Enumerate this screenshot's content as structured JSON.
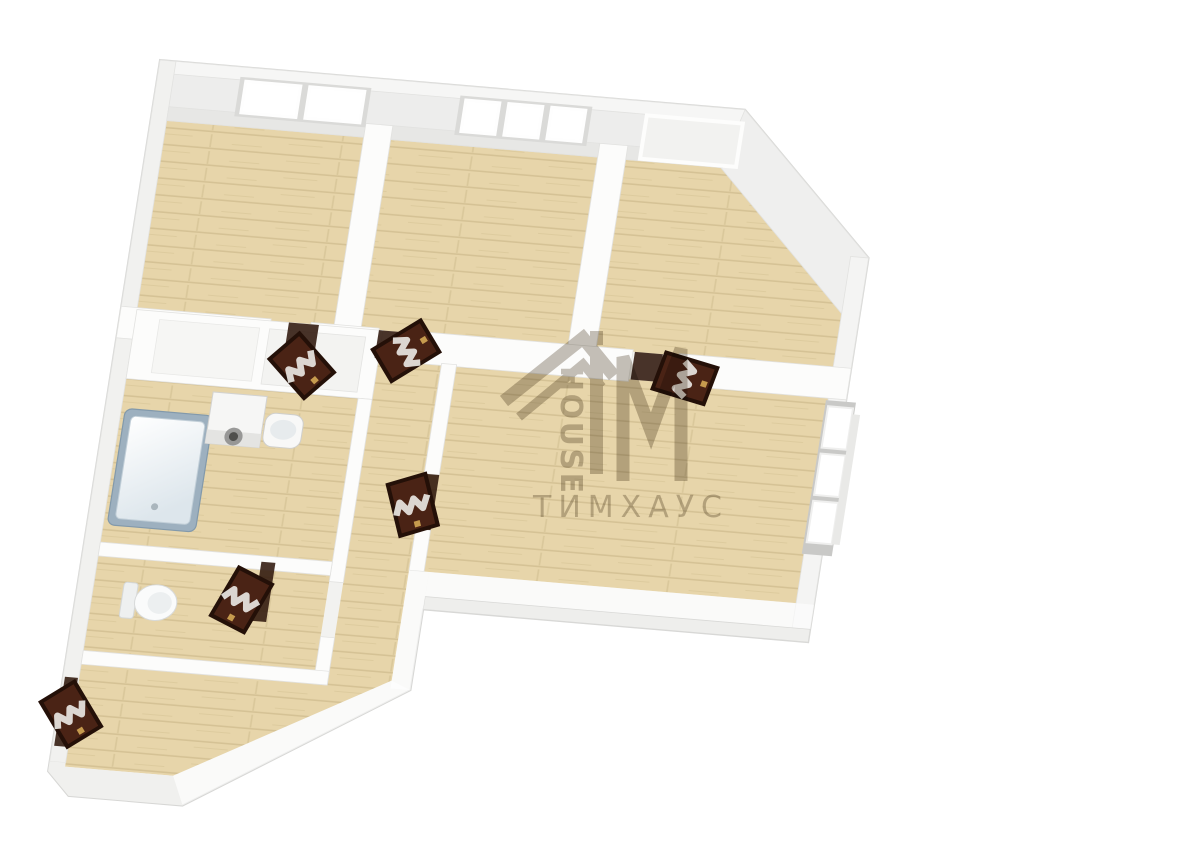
{
  "page": {
    "background": "#ffffff",
    "description": "3D top-down rendering of an apartment floor plan with translucent white walls and light wood floors"
  },
  "watermark": {
    "logo_letters": "TiM",
    "vertical_label": "HOUSE",
    "brand_label": "ТИМХАУС",
    "color": "#8d8374"
  },
  "floor_plan": {
    "type": "3d-apartment-top-view",
    "colors": {
      "floor_wood": "#e7d5aa",
      "plank_line": "#d5c295",
      "wall_white": "#fcfcfb",
      "outer_wall": "#f2f2f0",
      "wall_edge": "#d7d7d5",
      "door_leaf": "#4a2315",
      "door_frame_dark": "#2a150b",
      "door_glass_zigzag": "#e8e6e2",
      "door_handle": "#c69b4e",
      "bathtub_rim": "#9db0bf",
      "fixture_white": "#f8f8f7"
    },
    "rooms": [
      {
        "name": "bedroom-top-left",
        "windows": 2
      },
      {
        "name": "bedroom-top-middle",
        "windows": 3
      },
      {
        "name": "room-top-right-chamfered",
        "windows": 1
      },
      {
        "name": "living-room",
        "windows": 1
      },
      {
        "name": "bathroom",
        "fixtures": [
          "bathtub",
          "washing-machine",
          "sink"
        ]
      },
      {
        "name": "wc",
        "fixtures": [
          "toilet"
        ]
      },
      {
        "name": "hallway",
        "fixtures": []
      },
      {
        "name": "room-bottom-left-chamfered",
        "fixtures": []
      }
    ],
    "door_count": 6,
    "window_unit_count": 7
  }
}
